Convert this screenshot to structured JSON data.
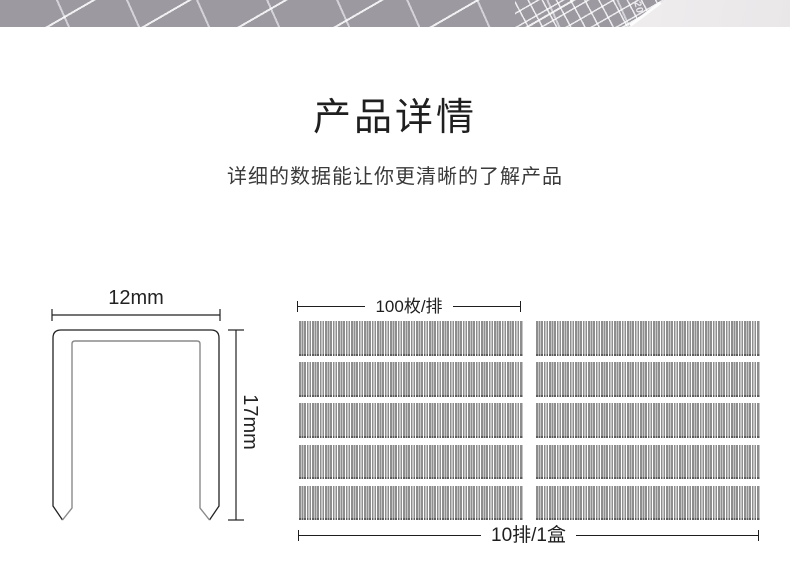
{
  "banner": {
    "ruler_label": "20"
  },
  "header": {
    "title": "产品详情",
    "subtitle": "详细的数据能让你更清晰的了解产品"
  },
  "staple_diagram": {
    "width_label": "12mm",
    "height_label": "17mm"
  },
  "pack_diagram": {
    "per_strip_label": "100枚/排",
    "per_box_label": "10排/1盒",
    "rows": 5,
    "columns": 2,
    "strips_total": 10
  },
  "colors": {
    "mat_grey": "#9c99a1",
    "surface_light": "#efeeef",
    "strip_bar": "#8e8e8e",
    "strip_tip": "#5d5d5d",
    "outline_dark": "#222222",
    "outline_grey": "#8a8a8a"
  }
}
